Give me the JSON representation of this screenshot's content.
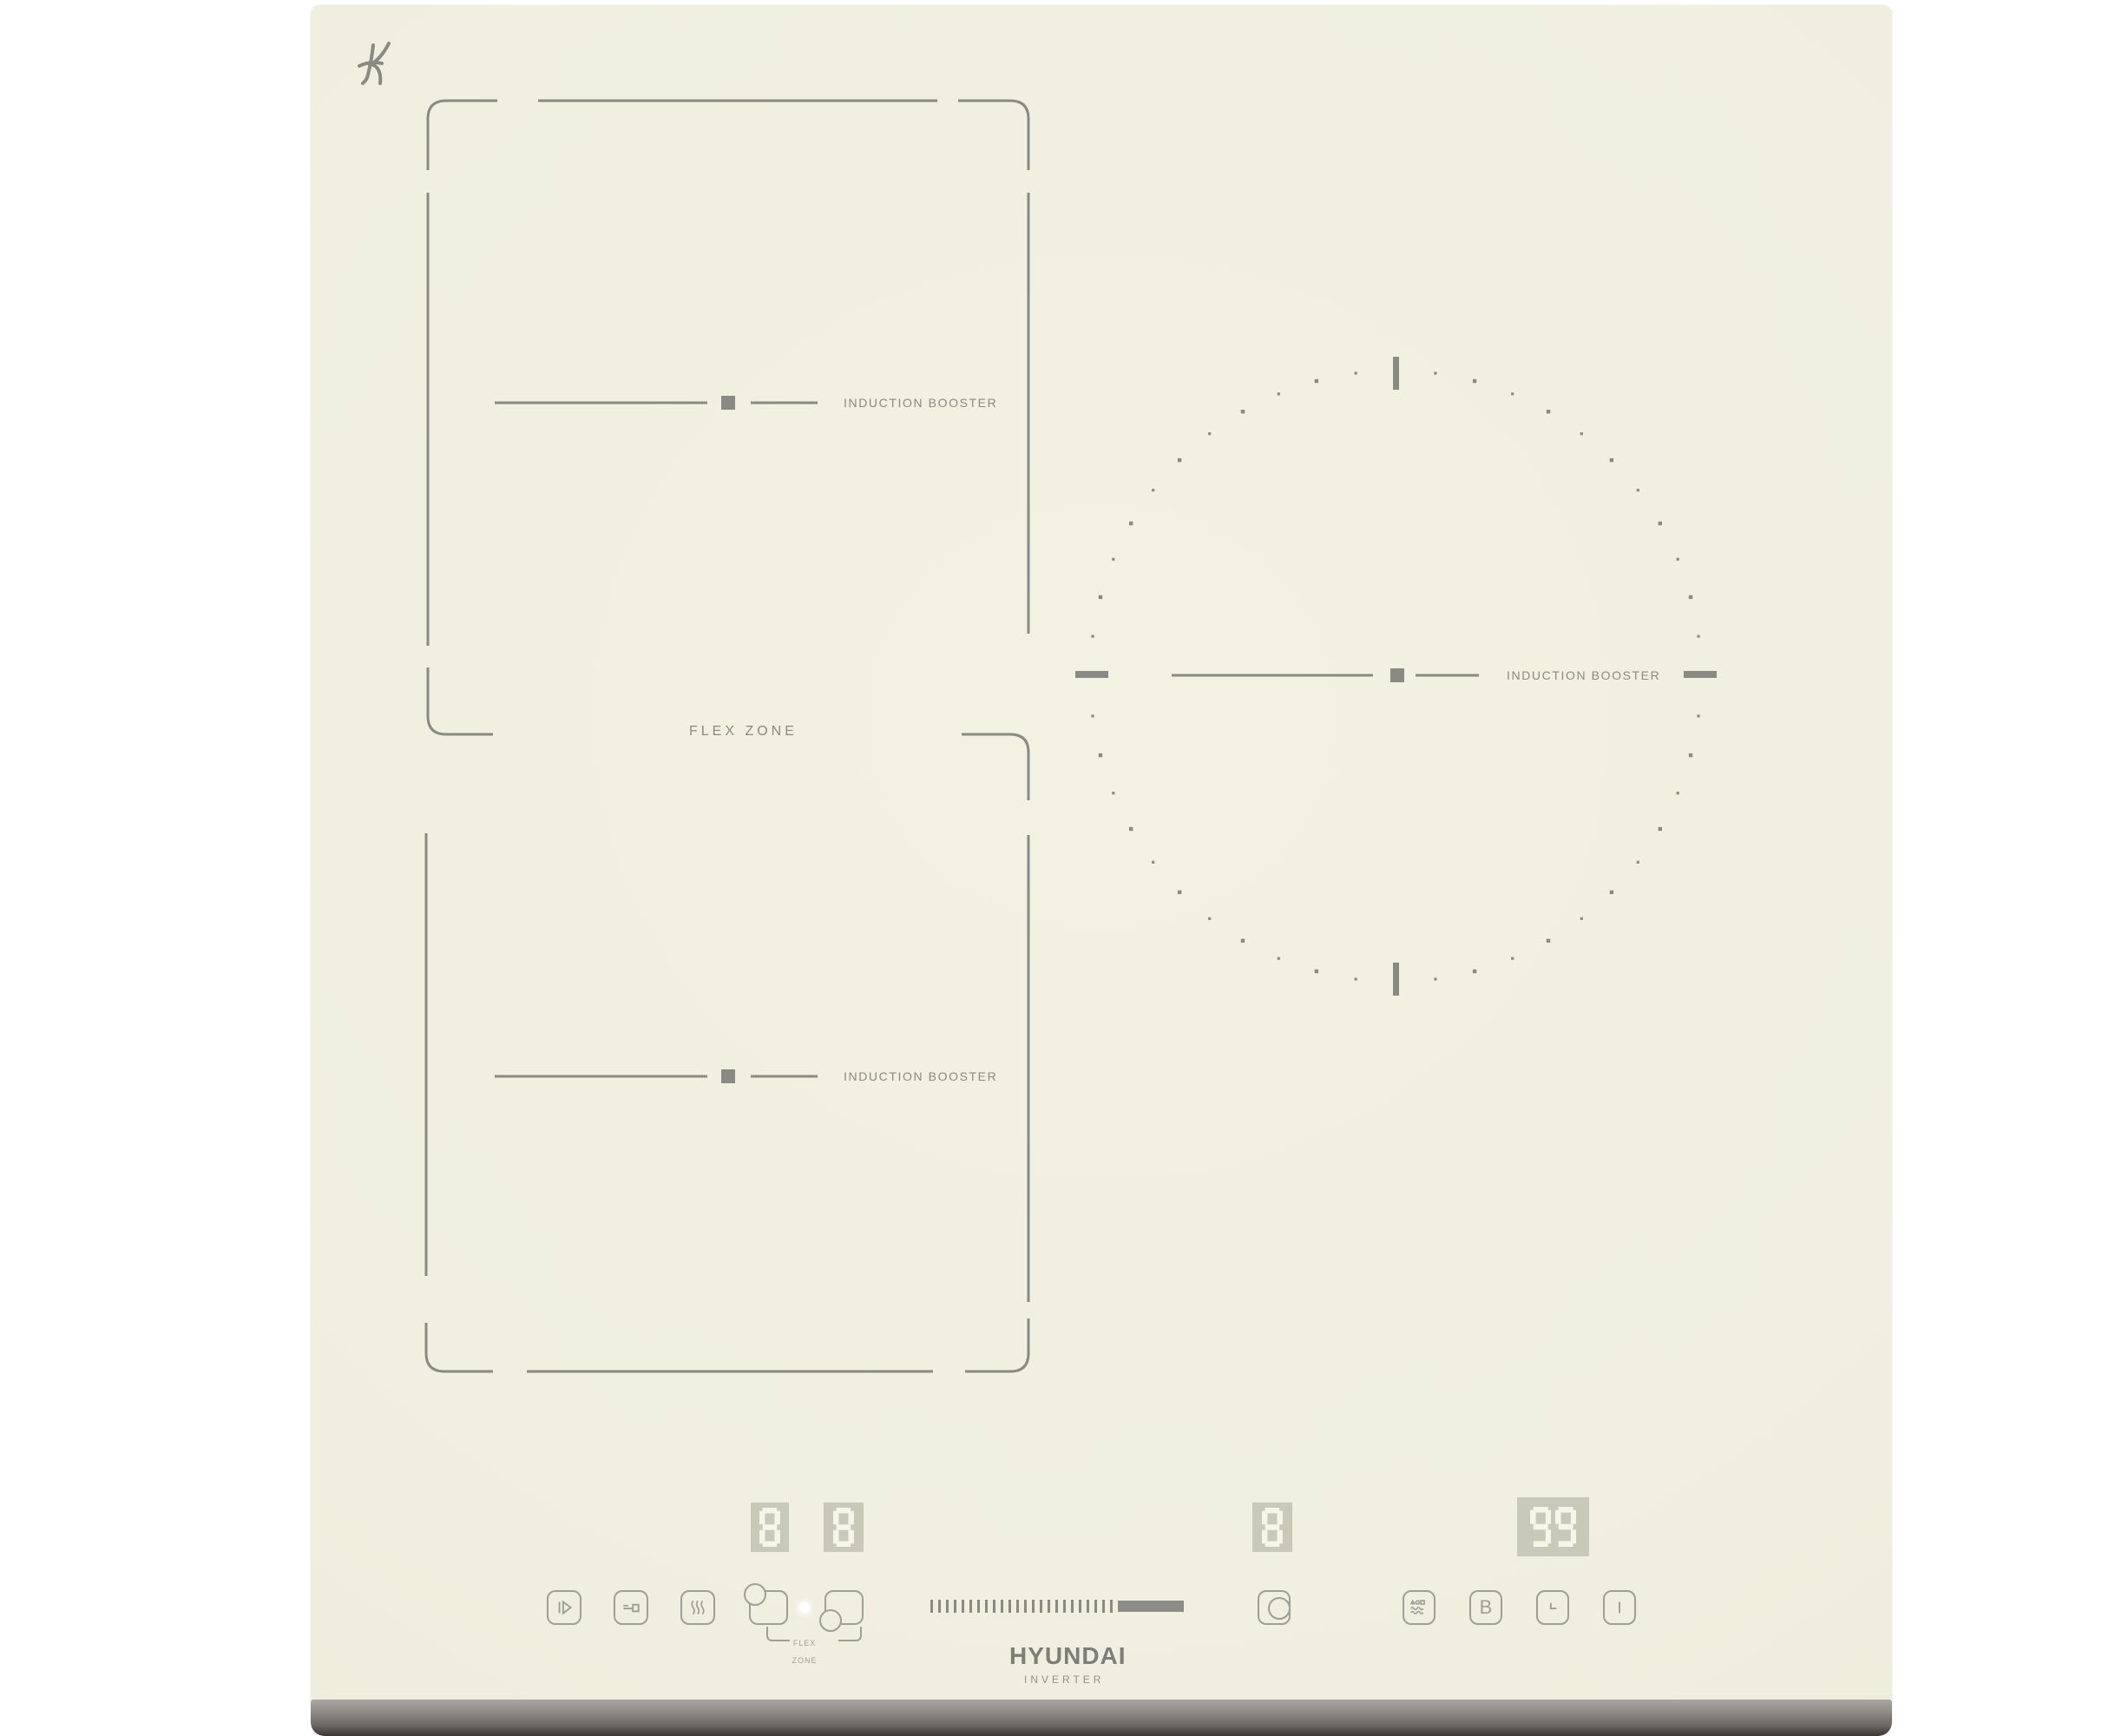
{
  "surface": {
    "base_color": "#f0efdf",
    "graphic_color": "#8a8a85",
    "control_color": "#9ca095"
  },
  "certification_mark": "K",
  "brand": {
    "logo": "HYUNDAI",
    "sub": "INVERTER"
  },
  "zones": {
    "booster_label": "INDUCTION BOOSTER",
    "flex_label": "FLEX ZONE"
  },
  "flex_selector": {
    "mini_label_line1": "FLEX",
    "mini_label_line2": "ZONE"
  },
  "displays": [
    {
      "name": "display-flex-upper",
      "value": "8"
    },
    {
      "name": "display-flex-lower",
      "value": "8"
    },
    {
      "name": "display-right-zone",
      "value": "8"
    },
    {
      "name": "display-timer",
      "value": "99"
    }
  ],
  "display_style": {
    "bg": "#c8c9b8",
    "segment": "#f6f5e9"
  },
  "buttons": [
    {
      "name": "power-button",
      "icon": "power"
    },
    {
      "name": "child-lock-button",
      "icon": "key"
    },
    {
      "name": "booster-button",
      "icon": "waves-vertical"
    },
    {
      "name": "flex-upper-select-button",
      "icon": "circle-top-left"
    },
    {
      "name": "flex-lower-select-button",
      "icon": "circle-bottom-left"
    },
    {
      "name": "right-zone-select-button",
      "icon": "circle-right"
    },
    {
      "name": "keep-warm-button",
      "icon": "shapes-over-waves"
    },
    {
      "name": "booster-b-button",
      "label": "B"
    },
    {
      "name": "timer-l-button",
      "icon": "l-mark"
    },
    {
      "name": "bar-button",
      "icon": "vertical-bar"
    }
  ],
  "slider": {
    "ticks": 24,
    "filled_block": true,
    "fill_color": "#8d8d87"
  },
  "led": {
    "state": "on",
    "color": "#ffffff"
  },
  "trim": {
    "top_color": "#aaa7a2",
    "bottom_color": "#3a3631"
  }
}
